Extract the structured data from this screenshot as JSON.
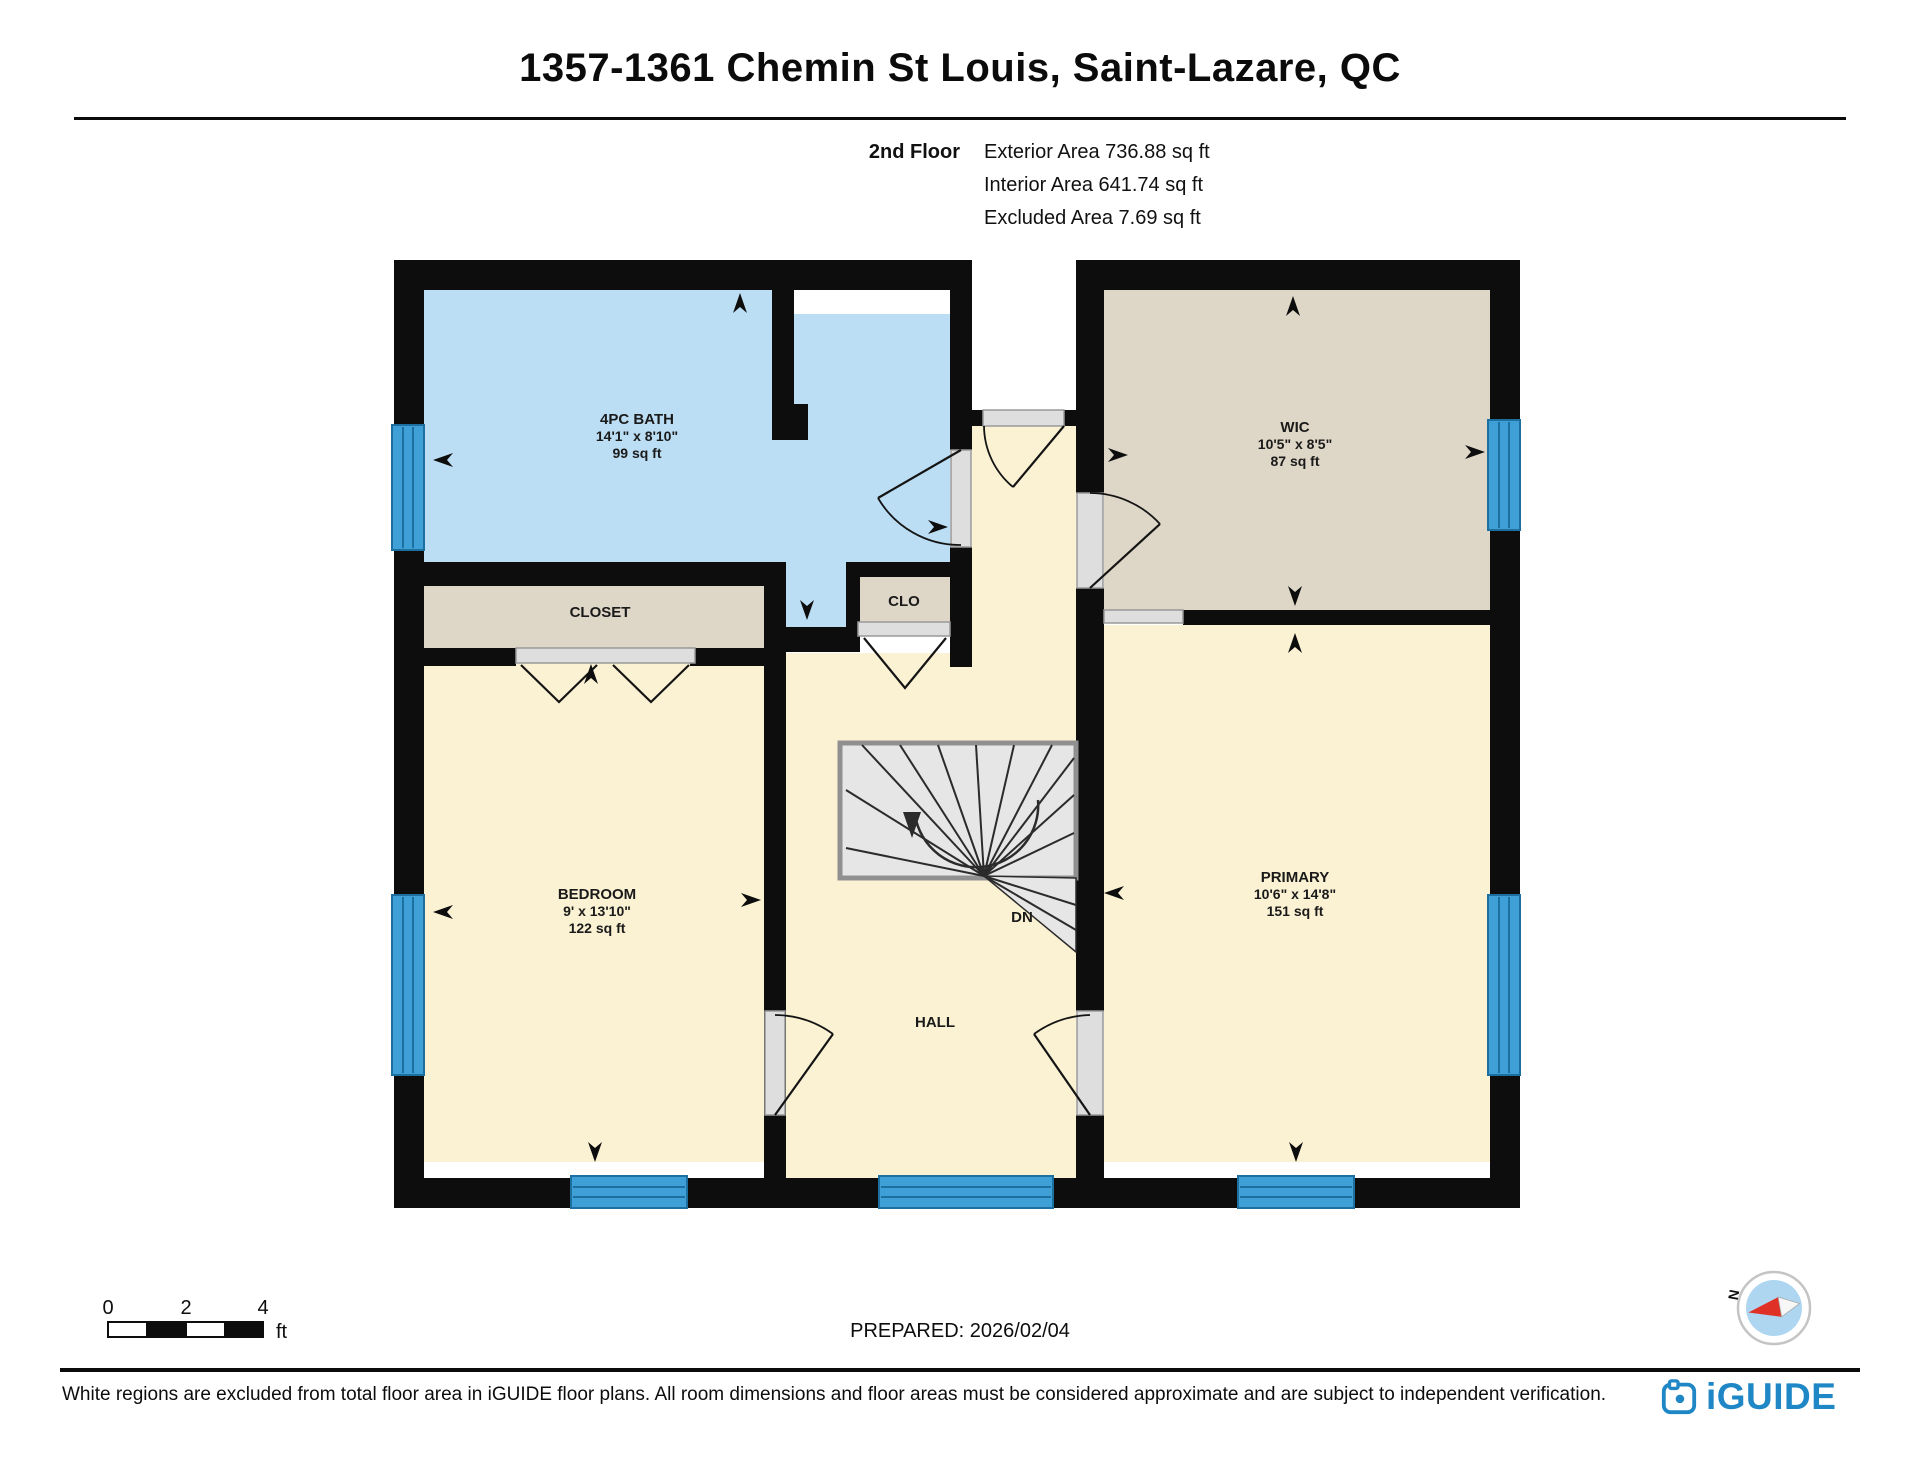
{
  "header": {
    "title": "1357-1361 Chemin St Louis, Saint-Lazare, QC",
    "floor": "2nd Floor",
    "stats": [
      "Exterior Area 736.88 sq ft",
      "Interior Area 641.74 sq ft",
      "Excluded Area 7.69 sq ft"
    ]
  },
  "rooms": {
    "bath": {
      "name": "4PC BATH",
      "dims": "14'1\" x 8'10\"",
      "area": "99 sq ft"
    },
    "wic": {
      "name": "WIC",
      "dims": "10'5\" x 8'5\"",
      "area": "87 sq ft"
    },
    "bedroom": {
      "name": "BEDROOM",
      "dims": "9' x 13'10\"",
      "area": "122 sq ft"
    },
    "primary": {
      "name": "PRIMARY",
      "dims": "10'6\" x 14'8\"",
      "area": "151 sq ft"
    },
    "closet": {
      "name": "CLOSET"
    },
    "clo": {
      "name": "CLO"
    },
    "hall": {
      "name": "HALL"
    },
    "stairs_direction": "DN"
  },
  "footer": {
    "scale": {
      "ticks": [
        "0",
        "2",
        "4"
      ],
      "unit": "ft"
    },
    "prepared": "PREPARED: 2026/02/04",
    "disclaimer": "White regions are excluded from total floor area in iGUIDE floor plans. All room dimensions and floor areas must be considered approximate and are subject to independent verification.",
    "brand": "iGUIDE",
    "compass_n": "N"
  },
  "colors": {
    "wall": "#0d0d0d",
    "bath_floor": "#bcdef4",
    "beige_floor": "#fbf2d3",
    "tan_floor": "#ded6c6",
    "window_blue": "#3fa0d8",
    "brand_blue": "#1f87c5",
    "compass_red": "#e03127"
  }
}
